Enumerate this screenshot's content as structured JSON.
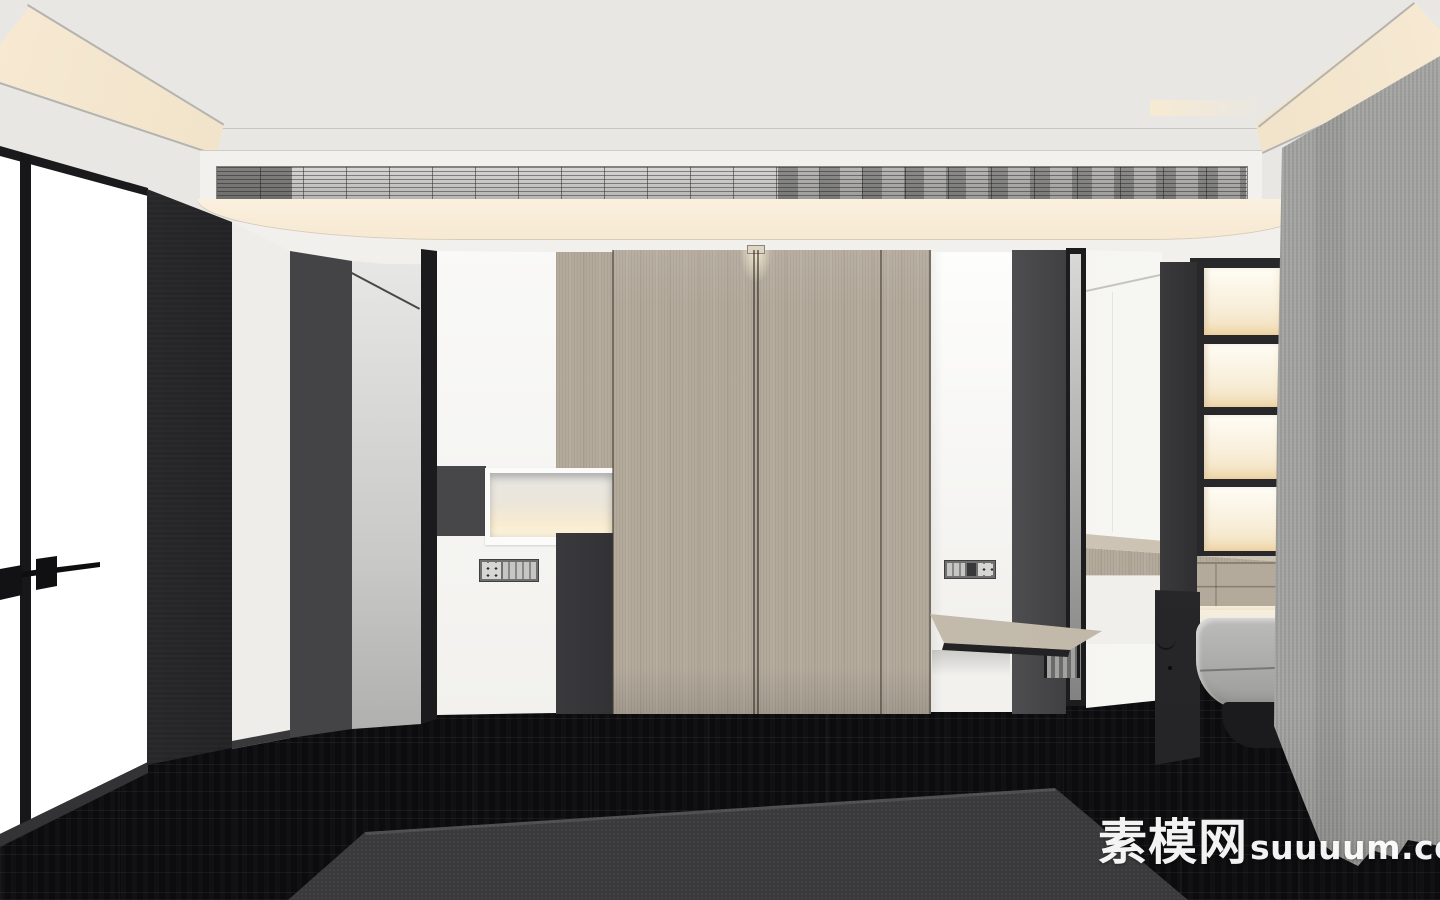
{
  "watermark": {
    "cn": "素模网",
    "latin": "suuuum.com"
  },
  "palette": {
    "ceiling": "#e9e7e3",
    "wall": "#f2f0ec",
    "fascia": "#f3f1ed",
    "cove": "#f7e9d2",
    "wood": "#b3aa9c",
    "floor": "#0c0c0e",
    "rug": "#3a3a3c",
    "curtain": "#a1a19f",
    "chair": "#9b9b99",
    "watermark": "#ffffff"
  },
  "scene": {
    "type": "3d-interior-render",
    "description": "Modern hotel-room entry hallway: tray ceiling with warm cove lighting and linear AC vent grille, central light-wood wardrobe doors flanked by white columns with power-socket plates, backlit display niche, glass door with black frame and lever handle at left, dark corridor recess, backlit open shelving with wood counter and cantilevered desk at right, grey fabric curtain, grey lounge chair, black wood-plank floor with dark grey area rug"
  }
}
